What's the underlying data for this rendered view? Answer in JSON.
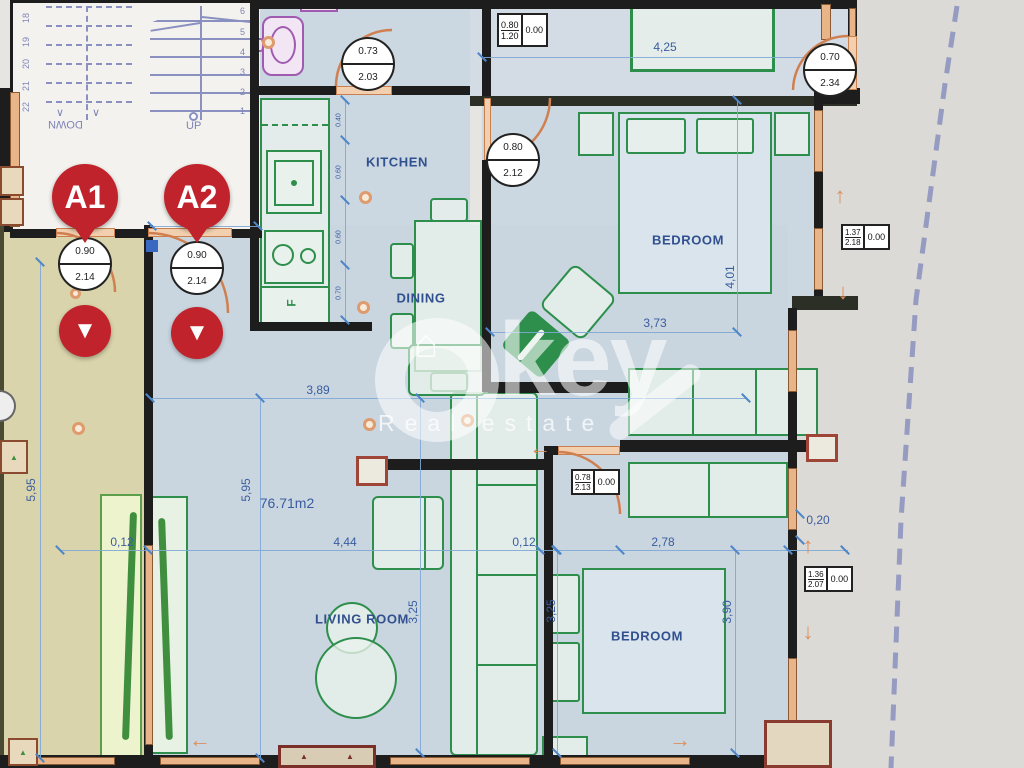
{
  "plan": {
    "units": {
      "a1": "A1",
      "a2": "A2"
    },
    "rooms": {
      "kitchen": "KITCHEN",
      "dining": "DINING",
      "bedroom_top": "BEDROOM",
      "bedroom_bottom": "BEDROOM",
      "living": "LIVING ROOM"
    },
    "area_label": "76.71m2",
    "stairs": {
      "up": "UP",
      "down": "DOWN",
      "left_numbers": [
        "18",
        "19",
        "20",
        "21",
        "22"
      ],
      "right_numbers": [
        "6",
        "5",
        "4",
        "3",
        "2",
        "1"
      ]
    },
    "door_specs": {
      "a1_entrance": {
        "width": "0.90",
        "height": "2.14"
      },
      "a2_entrance": {
        "width": "0.90",
        "height": "2.14"
      },
      "bathroom": {
        "width": "0.73",
        "height": "2.03"
      },
      "bedroom_top": {
        "width": "0.80",
        "height": "2.12"
      },
      "terrace": {
        "width": "0.70",
        "height": "2.34"
      }
    },
    "window_specs": {
      "top": {
        "width": "0.80",
        "height": "1.20",
        "sill": "0.00"
      },
      "right_upper": {
        "width": "1.37",
        "height": "2.18",
        "sill": "0.00"
      },
      "right_lower": {
        "width": "1.36",
        "height": "2.07",
        "sill": "0.00"
      },
      "hall": {
        "width": "0.78",
        "height": "2.13",
        "sill": "0.00"
      }
    },
    "dimensions": {
      "bath": "1,70",
      "bed_top_w": "4,25",
      "bed_top_inner": "3,73",
      "bed_top_d": "4,01",
      "hall_w": "3,89",
      "left_h": "5,95",
      "mid_h": "5,95",
      "wall_l": "0,12",
      "living_w": "4,44",
      "wall_m": "0,12",
      "bed_bot_w": "2,78",
      "wall_r": "0,20",
      "living_d": "3,25",
      "bed_bot_dl": "3,25",
      "bed_bot_dr": "3,90",
      "kitchen_chain": [
        "0.40",
        "0.60",
        "0.60",
        "0.70"
      ]
    },
    "labels": {
      "fridge": "F"
    },
    "watermark": {
      "brand": "key",
      "tagline": "Real estate"
    },
    "icons": {
      "arrow_up": "↑",
      "arrow_down": "↓",
      "arrow_left": "←",
      "arrow_right": "→",
      "marker_arrow": "▼",
      "house": "⌂",
      "hatch": "▲",
      "step_arrow": "∨"
    },
    "colors": {
      "wall": "#1d1d1d",
      "interior": "#cbd7e1",
      "terrace": "#d9d4ab",
      "furniture_green": "#2e8f4c",
      "door_orange": "#d08050",
      "dim_blue": "#3a5da0",
      "marker_red": "#c0232b",
      "stair_purple": "#8a90bf",
      "boundary_purple": "#8a8fbd"
    }
  }
}
